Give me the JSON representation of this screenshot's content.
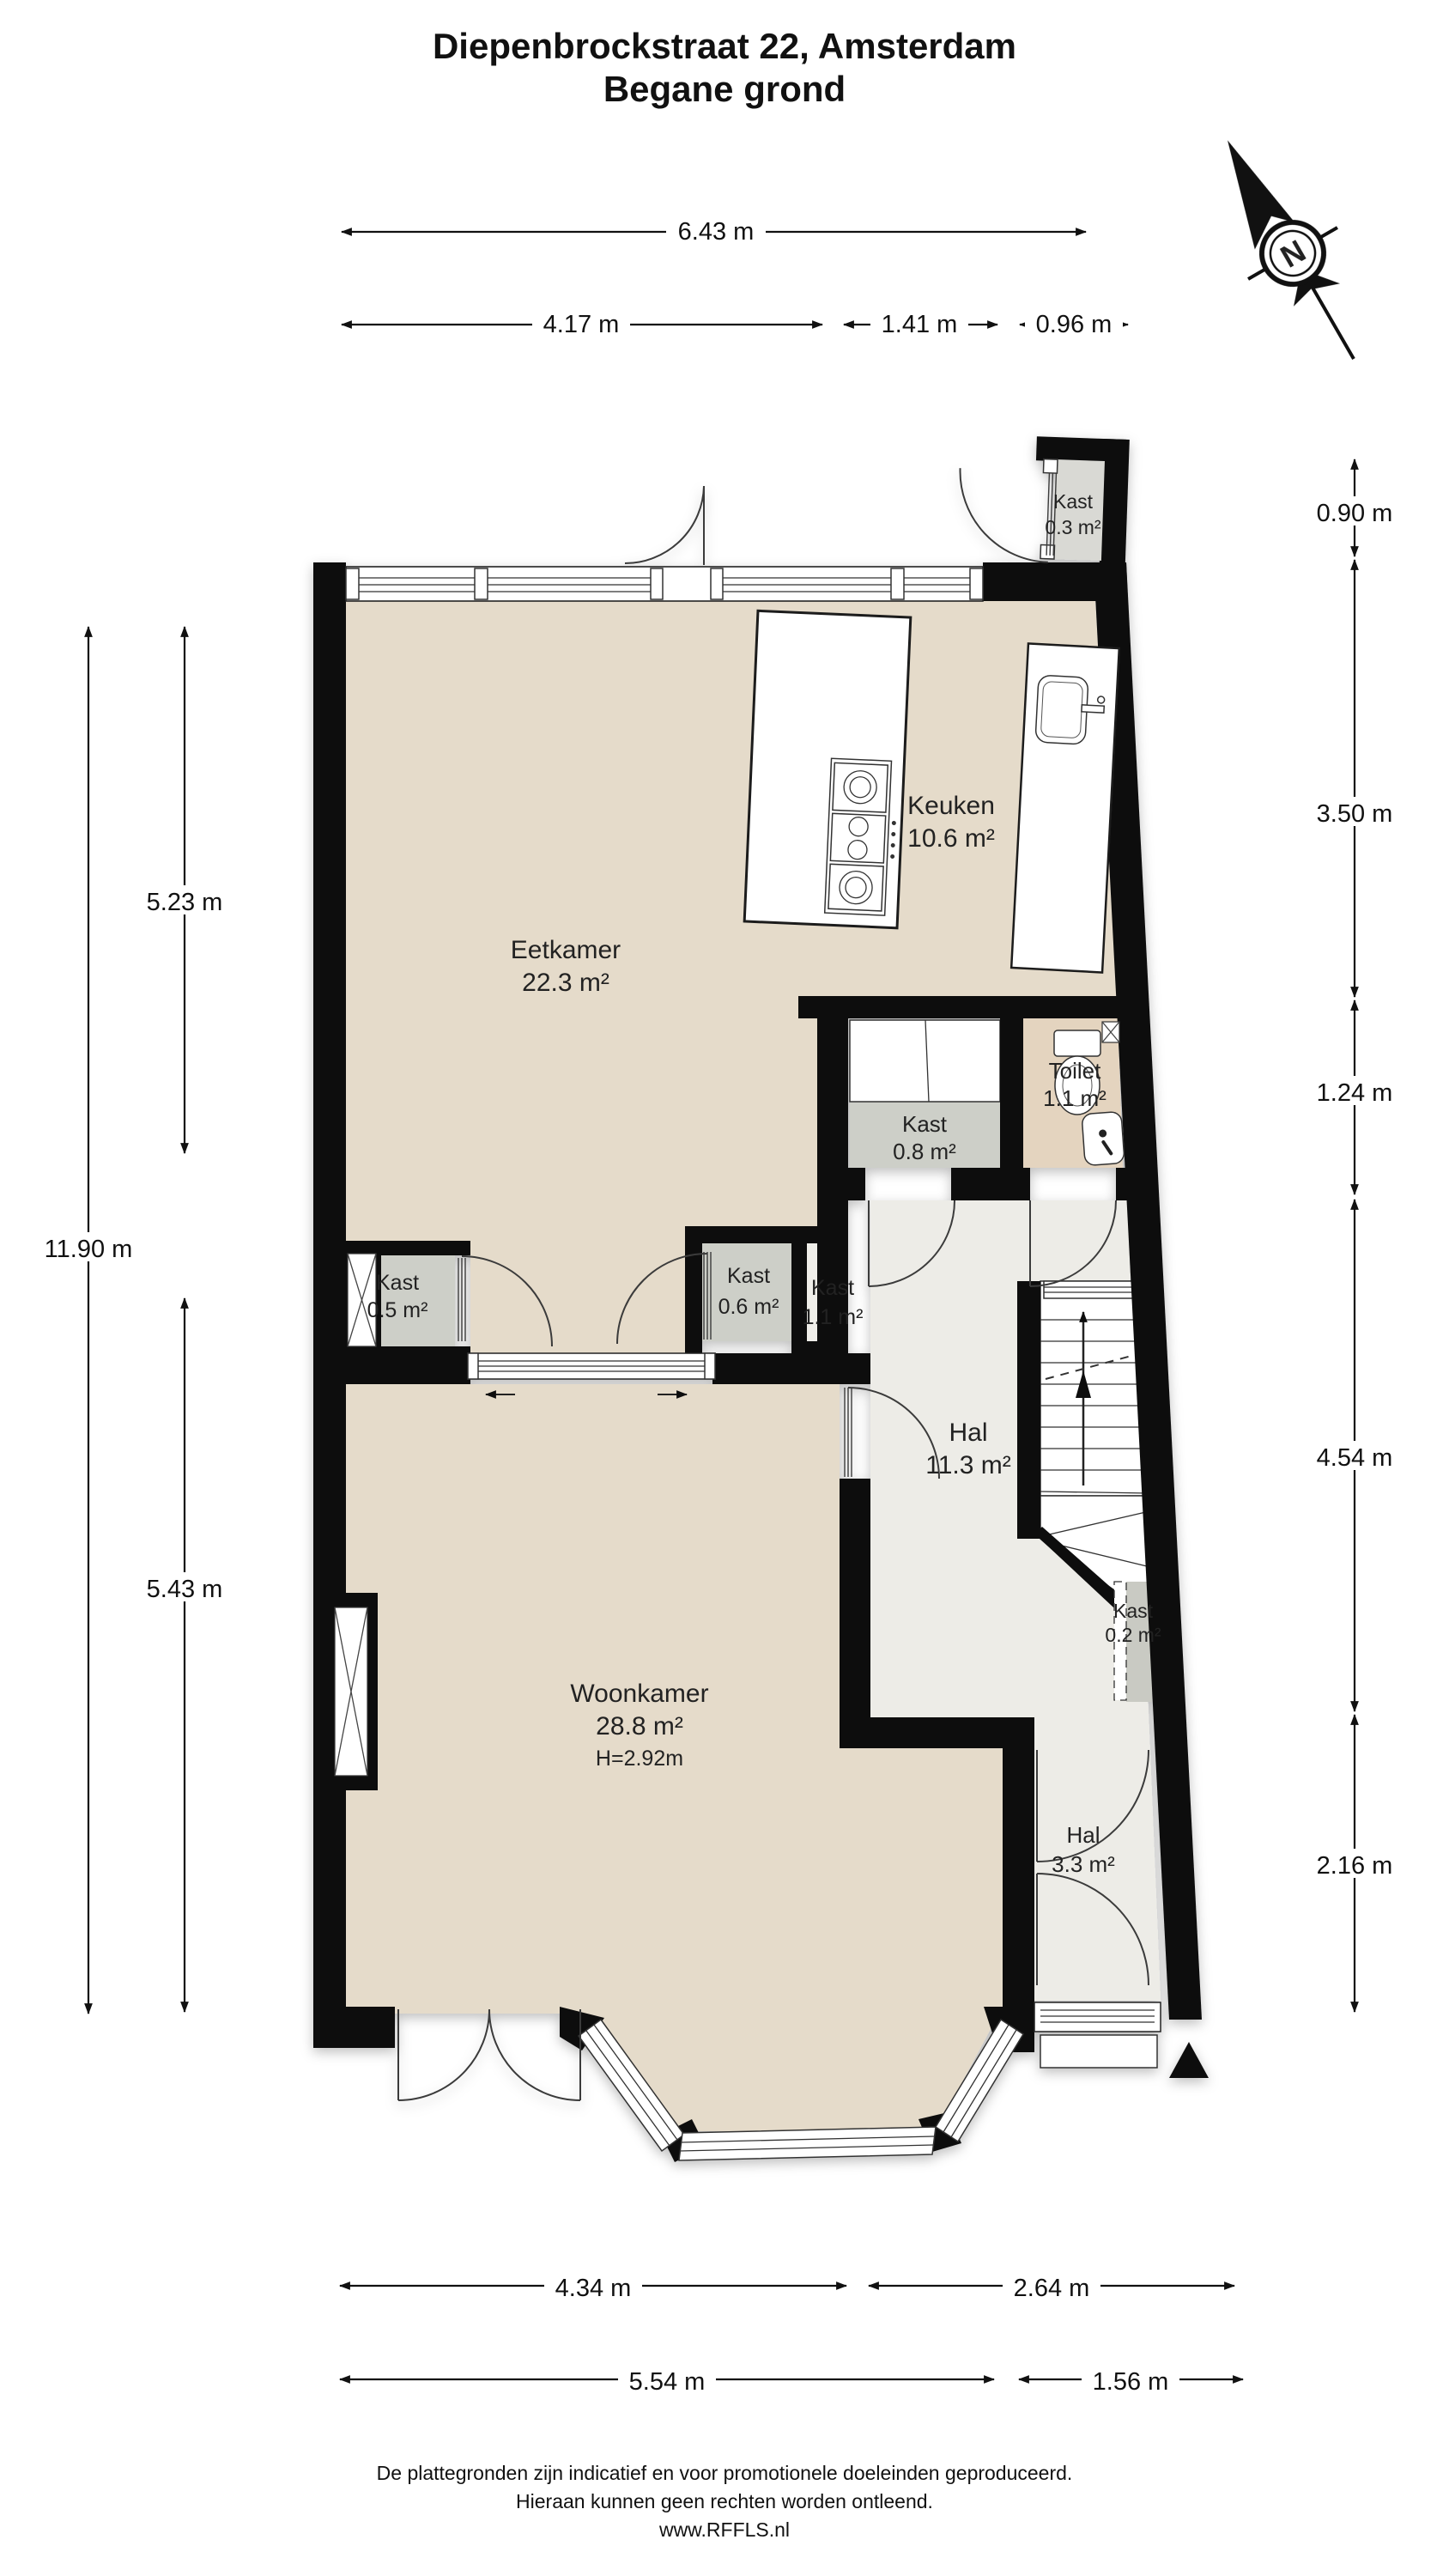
{
  "header": {
    "title": "Diepenbrockstraat 22, Amsterdam",
    "subtitle": "Begane grond"
  },
  "compass": {
    "north_label": "N"
  },
  "rooms": [
    {
      "id": "kast-03",
      "name": "Kast",
      "area": "0.3 m²"
    },
    {
      "id": "keuken",
      "name": "Keuken",
      "area": "10.6 m²"
    },
    {
      "id": "eetkamer",
      "name": "Eetkamer",
      "area": "22.3 m²"
    },
    {
      "id": "toilet",
      "name": "Toilet",
      "area": "1.1 m²"
    },
    {
      "id": "kast-08",
      "name": "Kast",
      "area": "0.8 m²"
    },
    {
      "id": "kast-05",
      "name": "Kast",
      "area": "0.5 m²"
    },
    {
      "id": "kast-06",
      "name": "Kast",
      "area": "0.6 m²"
    },
    {
      "id": "kast-11",
      "name": "Kast",
      "area": "1.1 m²"
    },
    {
      "id": "hal",
      "name": "Hal",
      "area": "11.3 m²"
    },
    {
      "id": "kast-02",
      "name": "Kast",
      "area": "0.2 m²"
    },
    {
      "id": "woonkamer",
      "name": "Woonkamer",
      "area": "28.8 m²",
      "ceiling_height": "H=2.92m"
    },
    {
      "id": "hal-entree",
      "name": "Hal",
      "area": "3.3 m²"
    }
  ],
  "dimensions": {
    "top": [
      "6.43 m"
    ],
    "top2": [
      "4.17 m",
      "1.41 m",
      "0.96 m"
    ],
    "left": [
      "11.90 m",
      "5.23 m",
      "5.43 m"
    ],
    "right": [
      "0.90 m",
      "3.50 m",
      "1.24 m",
      "4.54 m",
      "2.16 m"
    ],
    "bottom": [
      "4.34 m",
      "2.64 m"
    ],
    "bottom2": [
      "5.54 m",
      "1.56 m"
    ]
  },
  "footer": {
    "line1": "De plattegronden zijn indicatief en voor promotionele doeleinden geproduceerd.",
    "line2": "Hieraan kunnen geen rechten worden ontleend.",
    "line3": "www.RFFLS.nl"
  },
  "colors": {
    "wall": "#101010",
    "floor_living": "#e5dbca",
    "floor_hall": "#edece7",
    "floor_toilet": "#e4d4bf",
    "floor_closet": "#cdcfc8",
    "floor_closet_light": "#efeee9",
    "floor_closet_top": "#d9d9d4",
    "floor_closet_narrow": "#c9cac3"
  }
}
